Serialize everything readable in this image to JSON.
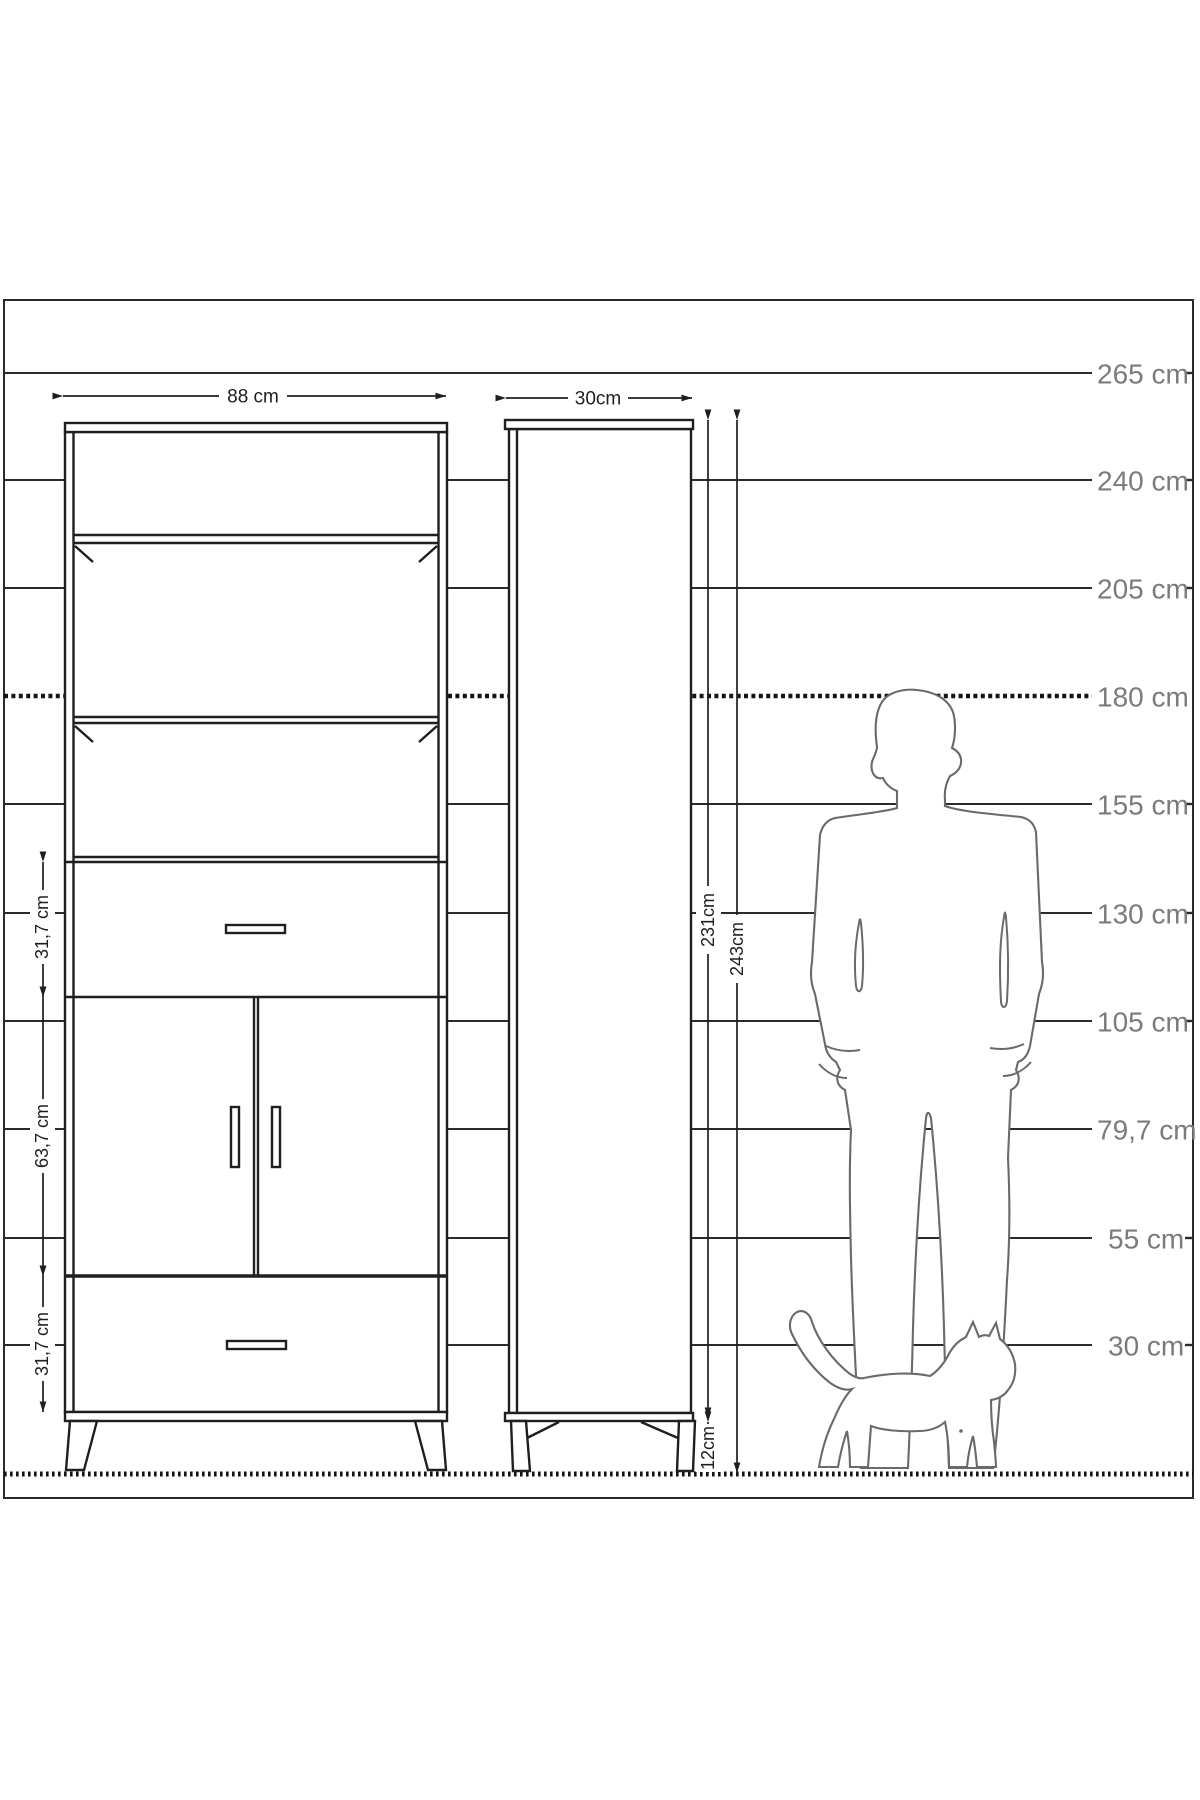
{
  "diagram_title": "cabinet-dimension-drawing",
  "colors": {
    "line": "#1f1f1f",
    "figure_outline": "#6a6a6a",
    "scale_label": "#7b7b7b",
    "background": "#ffffff"
  },
  "front_view": {
    "width_label": "88 cm",
    "upper_drawer_height_label": "31,7 cm",
    "doors_height_label": "63,7 cm",
    "lower_drawer_height_label": "31,7 cm"
  },
  "side_view": {
    "depth_label": "30cm",
    "body_height_label": "231cm",
    "total_height_label": "243cm",
    "leg_height_label": "12cm"
  },
  "scale": {
    "items": [
      {
        "label": "265 cm"
      },
      {
        "label": "240 cm"
      },
      {
        "label": "205 cm"
      },
      {
        "label": "180 cm"
      },
      {
        "label": "155 cm"
      },
      {
        "label": "130 cm"
      },
      {
        "label": "105 cm"
      },
      {
        "label": "79,7 cm"
      },
      {
        "label": "55 cm"
      },
      {
        "label": "30 cm"
      }
    ]
  },
  "figures": {
    "person_icon": "person-silhouette",
    "cat_icon": "cat-silhouette"
  }
}
